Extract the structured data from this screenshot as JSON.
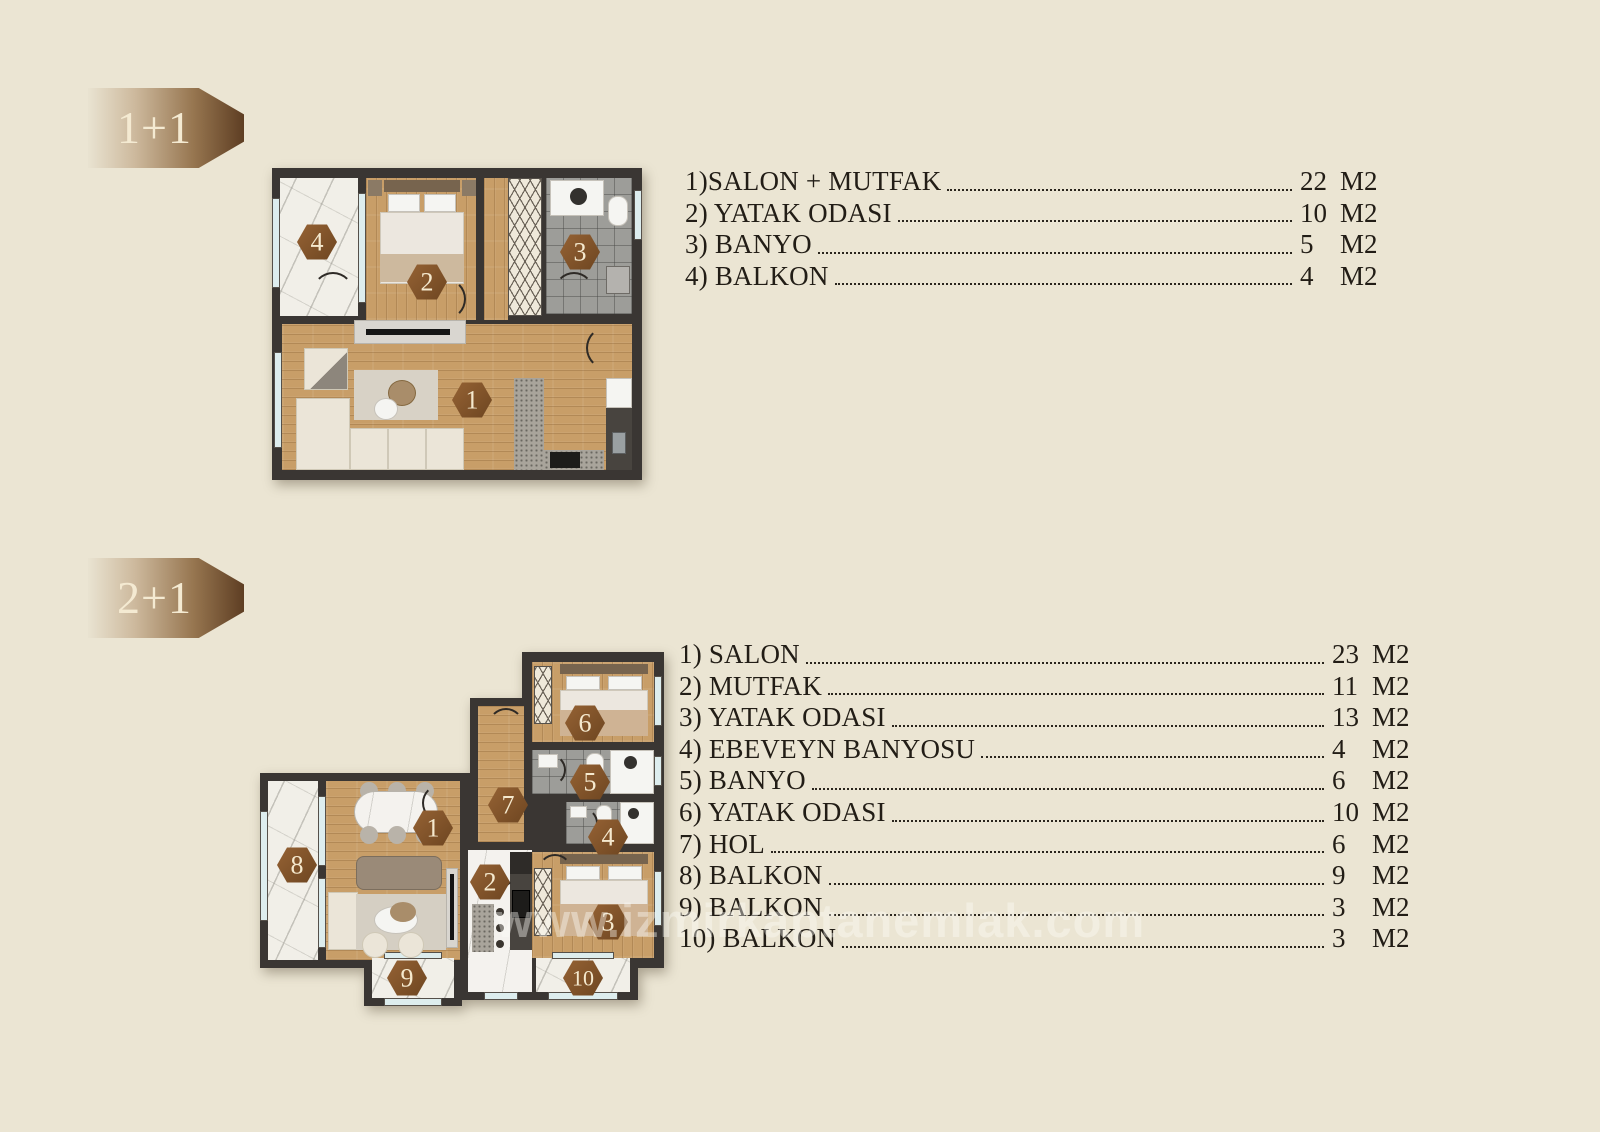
{
  "page": {
    "watermark": "www.izmirkaptanemlak.com",
    "background": "#ebe5d3"
  },
  "colors": {
    "accent_brown": "#8a5a2c",
    "wall": "#3a3633",
    "wood": "#c89e68",
    "badge_text": "#f4ead2",
    "list_text": "#221d16"
  },
  "sections": [
    {
      "badge": "1+1",
      "items": [
        {
          "label": "1)SALON + MUTFAK",
          "value": "22",
          "unit": "M2"
        },
        {
          "label": "2) YATAK ODASI",
          "value": "10",
          "unit": "M2"
        },
        {
          "label": "3) BANYO",
          "value": "5",
          "unit": "M2"
        },
        {
          "label": "4) BALKON",
          "value": "4",
          "unit": "M2"
        }
      ],
      "markers": [
        "1",
        "2",
        "3",
        "4"
      ]
    },
    {
      "badge": "2+1",
      "items": [
        {
          "label": "1) SALON",
          "value": "23",
          "unit": "M2"
        },
        {
          "label": "2) MUTFAK",
          "value": "11",
          "unit": "M2"
        },
        {
          "label": "3) YATAK ODASI",
          "value": "13",
          "unit": "M2"
        },
        {
          "label": "4) EBEVEYN BANYOSU",
          "value": "4",
          "unit": "M2"
        },
        {
          "label": "5) BANYO",
          "value": "6",
          "unit": "M2"
        },
        {
          "label": "6) YATAK ODASI",
          "value": "10",
          "unit": "M2"
        },
        {
          "label": "7) HOL",
          "value": "6",
          "unit": "M2"
        },
        {
          "label": "8) BALKON",
          "value": "9",
          "unit": "M2"
        },
        {
          "label": "9) BALKON",
          "value": "3",
          "unit": "M2"
        },
        {
          "label": "10) BALKON",
          "value": "3",
          "unit": "M2"
        }
      ],
      "markers": [
        "1",
        "2",
        "3",
        "4",
        "5",
        "6",
        "7",
        "8",
        "9",
        "10"
      ]
    }
  ]
}
